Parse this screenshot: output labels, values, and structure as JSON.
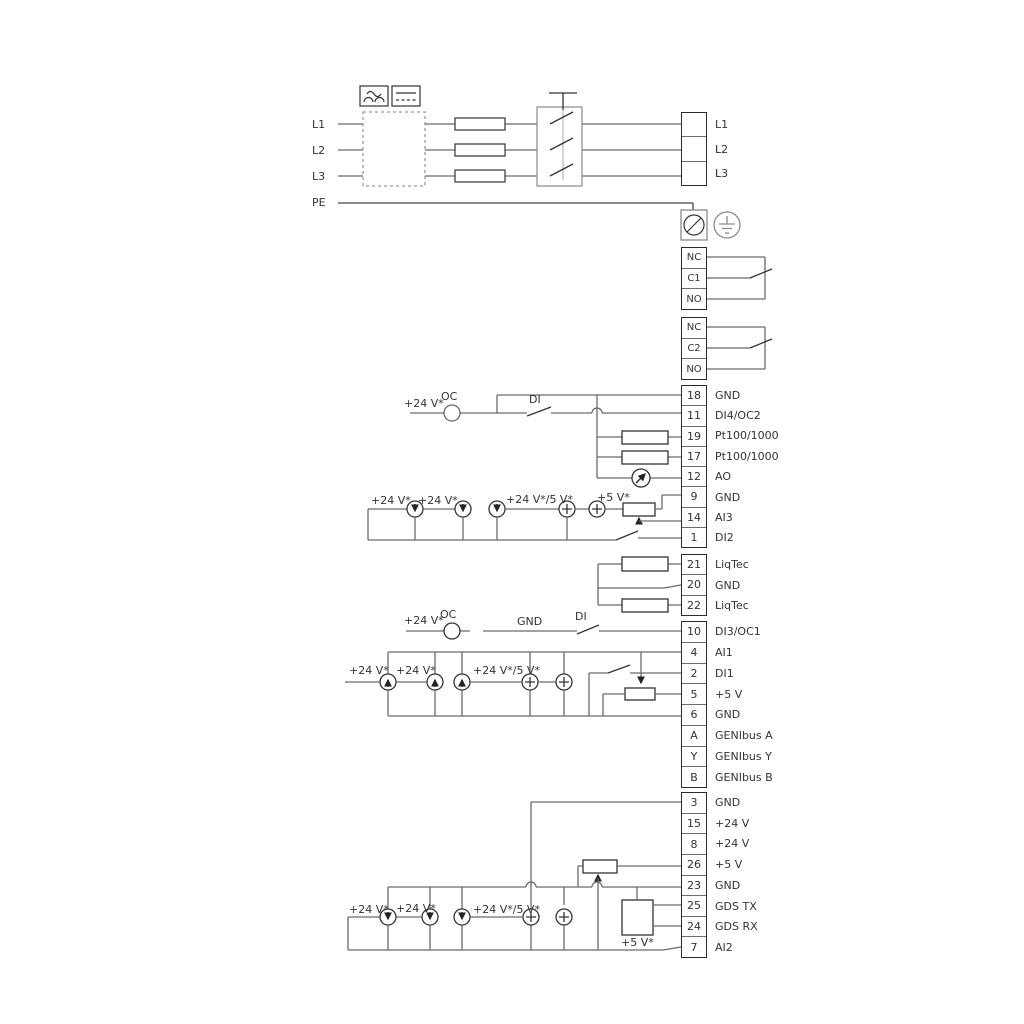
{
  "title": "Frequency converter wiring diagram",
  "mains_left": [
    "L1",
    "L2",
    "L3",
    "PE"
  ],
  "mains_right": [
    {
      "num": "",
      "label": "L1"
    },
    {
      "num": "",
      "label": "L2"
    },
    {
      "num": "",
      "label": "L3"
    }
  ],
  "relay1": [
    {
      "num": "NC",
      "label": ""
    },
    {
      "num": "C1",
      "label": ""
    },
    {
      "num": "NO",
      "label": ""
    }
  ],
  "relay2": [
    {
      "num": "NC",
      "label": ""
    },
    {
      "num": "C2",
      "label": ""
    },
    {
      "num": "NO",
      "label": ""
    }
  ],
  "tb1": [
    {
      "num": "18",
      "label": "GND"
    },
    {
      "num": "11",
      "label": "DI4/OC2"
    },
    {
      "num": "19",
      "label": "Pt100/1000"
    },
    {
      "num": "17",
      "label": "Pt100/1000"
    },
    {
      "num": "12",
      "label": "AO"
    },
    {
      "num": "9",
      "label": "GND"
    },
    {
      "num": "14",
      "label": "AI3"
    },
    {
      "num": "1",
      "label": "DI2"
    }
  ],
  "tb2": [
    {
      "num": "21",
      "label": "LiqTec"
    },
    {
      "num": "20",
      "label": "GND"
    },
    {
      "num": "22",
      "label": "LiqTec"
    }
  ],
  "tb3": [
    {
      "num": "10",
      "label": "DI3/OC1"
    },
    {
      "num": "4",
      "label": "AI1"
    },
    {
      "num": "2",
      "label": "DI1"
    },
    {
      "num": "5",
      "label": "+5 V"
    },
    {
      "num": "6",
      "label": "GND"
    },
    {
      "num": "A",
      "label": "GENIbus A"
    },
    {
      "num": "Y",
      "label": "GENIbus Y"
    },
    {
      "num": "B",
      "label": "GENIbus B"
    }
  ],
  "tb4": [
    {
      "num": "3",
      "label": "GND"
    },
    {
      "num": "15",
      "label": "+24 V"
    },
    {
      "num": "8",
      "label": "+24 V"
    },
    {
      "num": "26",
      "label": "+5 V"
    },
    {
      "num": "23",
      "label": "GND"
    },
    {
      "num": "25",
      "label": "GDS TX"
    },
    {
      "num": "24",
      "label": "GDS RX"
    },
    {
      "num": "7",
      "label": "AI2"
    }
  ],
  "wire_labels": {
    "p24": "+24 V*",
    "p24_5": "+24 V*/5 V*",
    "p5s": "+5 V*",
    "oc": "OC",
    "di": "DI",
    "gnd": "GND"
  },
  "colors": {
    "wire": "#6b6b6b",
    "dark": "#333333",
    "block_border": "#2b2b2b"
  }
}
